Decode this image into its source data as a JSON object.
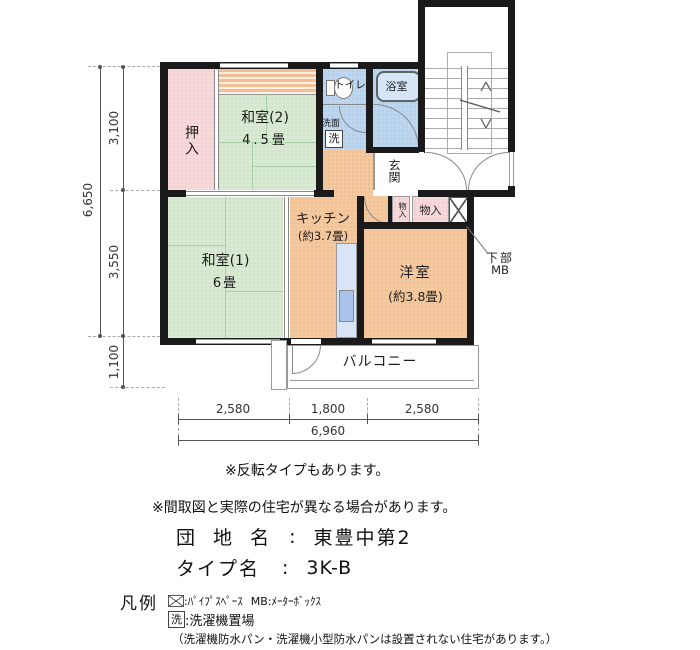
{
  "plan": {
    "rooms": {
      "washitsu2": {
        "name": "和室(2)",
        "size": "4.5畳"
      },
      "washitsu1": {
        "name": "和室(1)",
        "size": "6畳"
      },
      "kitchen": {
        "name": "キッチン",
        "size": "(約3.7畳)"
      },
      "western": {
        "name": "洋室",
        "size": "(約3.8畳)"
      },
      "oshiire": "押入",
      "toilet": "トイレ",
      "bath": "浴室",
      "senmen": "洗面",
      "washer_mark": "洗",
      "genkan": "玄関",
      "storage_small": "物入",
      "storage_large": "物入",
      "balcony": "バルコニー",
      "mb_line1": "下部",
      "mb_line2": "MB"
    },
    "dimensions": {
      "v_total": "6,650",
      "v_top": "3,100",
      "v_mid": "3,550",
      "v_balcony": "1,100",
      "h_left": "2,580",
      "h_center": "1,800",
      "h_right": "2,580",
      "h_total": "6,960"
    }
  },
  "notes": {
    "flip": "※反転タイプもあります。",
    "differ": "※間取図と実際の住宅が異なる場合があります。"
  },
  "info": {
    "estate_label": "団 地 名",
    "separator": ":",
    "estate_name": "東豊中第2",
    "type_label": "タイプ名",
    "type_name": "3K-B"
  },
  "legend": {
    "title": "凡例",
    "ps_text": ":ﾊﾟｲﾌﾟｽﾍﾟｰｽ",
    "mb_text": "MB:ﾒｰﾀｰﾎﾞｯｸｽ",
    "washer_symbol": "洗",
    "washer_text": ":洗濯機置場",
    "caution": "（洗濯機防水パン・洗濯機小型防水パンは設置されない住宅があります。）"
  },
  "colors": {
    "tatami": "#d9ead3",
    "pink": "#f9d8da",
    "orange": "#f6c89d",
    "blue": "#bdd6f0",
    "wall": "#1a1a1a"
  }
}
